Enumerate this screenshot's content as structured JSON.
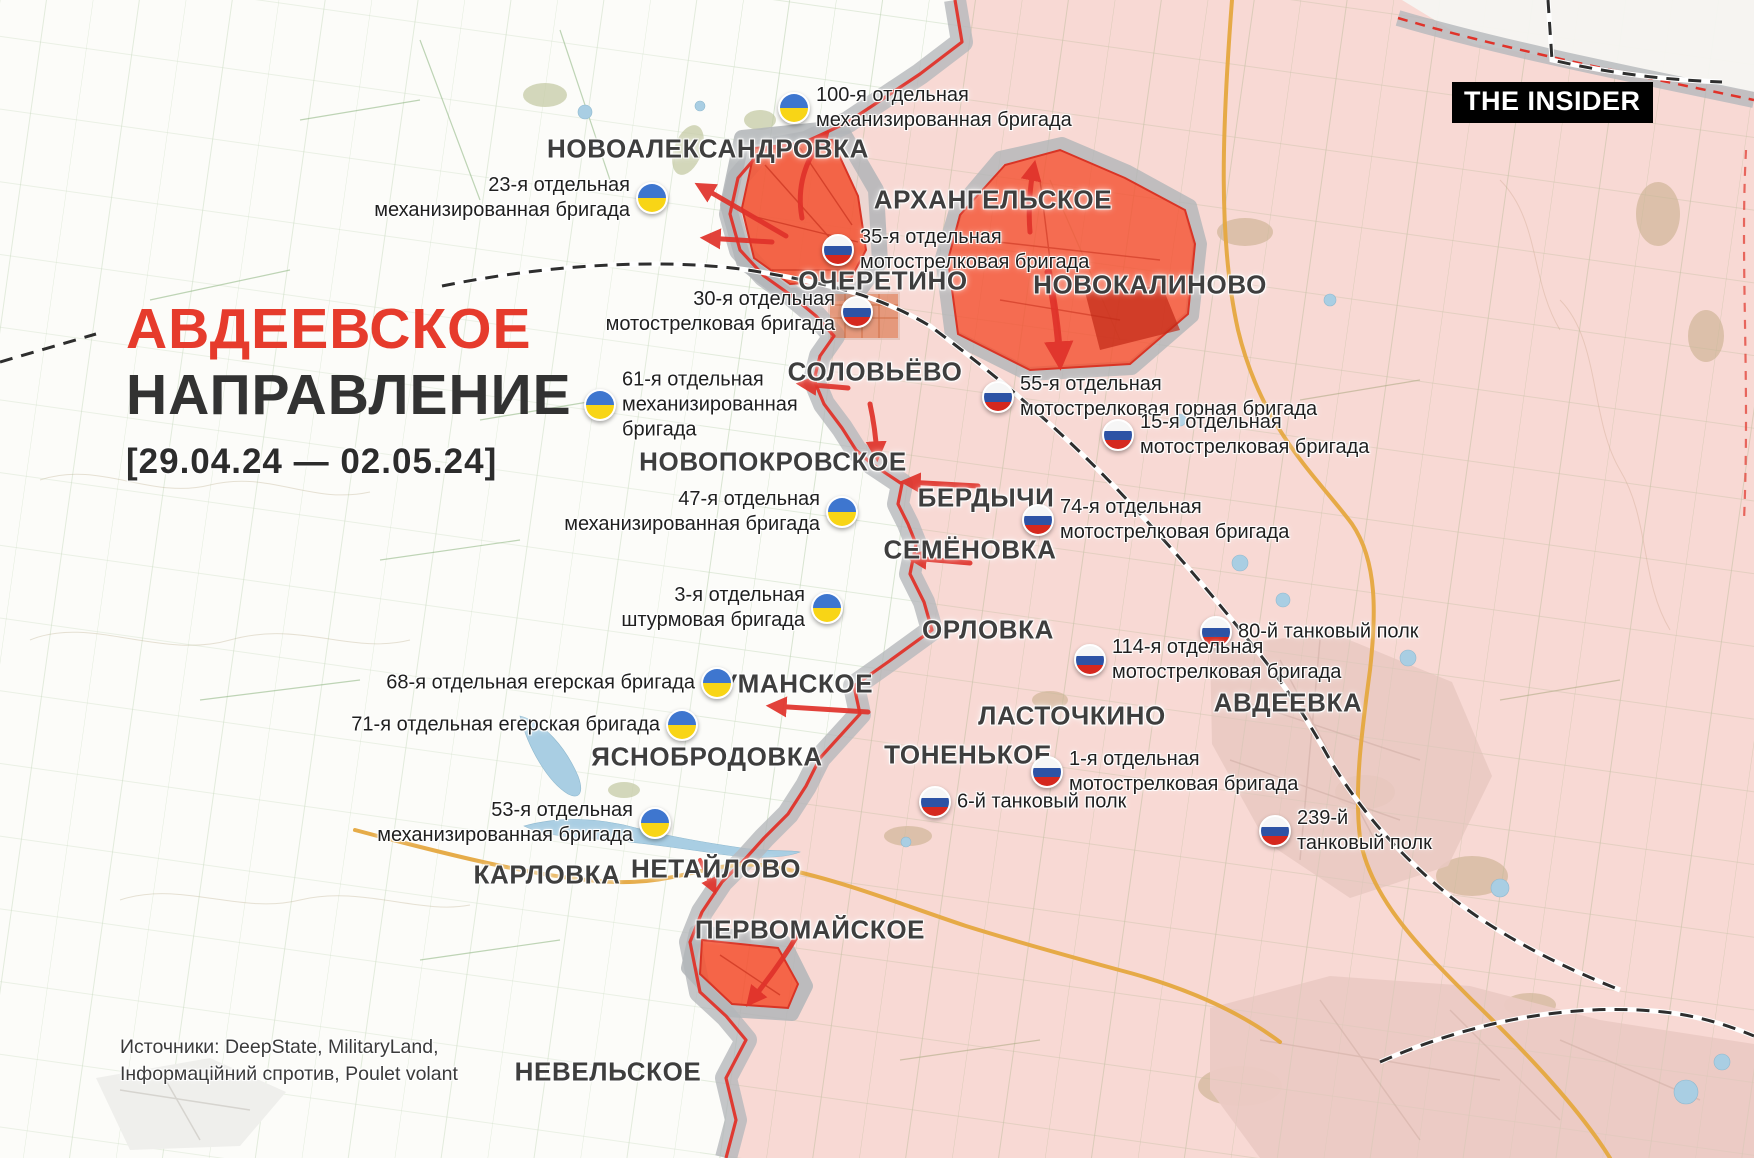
{
  "brand": {
    "logo_text": "THE INSIDER"
  },
  "header": {
    "title_line1": "АВДЕЕВСКОЕ",
    "title_line2": "НАПРАВЛЕНИЕ",
    "date_range": "[29.04.24 — 02.05.24]"
  },
  "sources": {
    "line1": "Источники: DeepState, MilitaryLand,",
    "line2": "Інформаційний спротив, Poulet volant"
  },
  "legend_colors": {
    "title_red": "#e63b2c",
    "front_line_red": "#e0332a",
    "assault_area_red": "#f4502f",
    "occupied_pink": "#f6dad6",
    "gray_zone": "#b5b8bb",
    "road_orange": "#e5a83f",
    "railway_black": "#2e2e2e",
    "ukraine_flag_blue": "#3e76cf",
    "ukraine_flag_yellow": "#f8d516",
    "russia_flag_blue": "#2d53a5",
    "russia_flag_red": "#d5281e"
  },
  "places": [
    {
      "name": "НОВОАЛЕКСАНДРОВКА",
      "x": 708,
      "y": 149
    },
    {
      "name": "АРХАНГЕЛЬСКОЕ",
      "x": 993,
      "y": 200
    },
    {
      "name": "ОЧЕРЕТИНО",
      "x": 883,
      "y": 281
    },
    {
      "name": "НОВОКАЛИНОВО",
      "x": 1150,
      "y": 285
    },
    {
      "name": "СОЛОВЬЁВО",
      "x": 875,
      "y": 372
    },
    {
      "name": "НОВОПОКРОВСКОЕ",
      "x": 773,
      "y": 462
    },
    {
      "name": "БЕРДЫЧИ",
      "x": 986,
      "y": 498
    },
    {
      "name": "СЕМЁНОВКА",
      "x": 970,
      "y": 550
    },
    {
      "name": "ОРЛОВКА",
      "x": 988,
      "y": 630
    },
    {
      "name": "УМАНСКОЕ",
      "x": 797,
      "y": 684
    },
    {
      "name": "ЛАСТОЧКИНО",
      "x": 1072,
      "y": 716
    },
    {
      "name": "АВДЕЕВКА",
      "x": 1288,
      "y": 703
    },
    {
      "name": "ТОНЕНЬКОЕ",
      "x": 968,
      "y": 755
    },
    {
      "name": "ЯСНОБРОДОВКА",
      "x": 707,
      "y": 757
    },
    {
      "name": "КАРЛОВКА",
      "x": 547,
      "y": 875
    },
    {
      "name": "НЕТАЙЛОВО",
      "x": 716,
      "y": 869
    },
    {
      "name": "ПЕРВОМАЙСКОЕ",
      "x": 810,
      "y": 930
    },
    {
      "name": "НЕВЕЛЬСКОЕ",
      "x": 608,
      "y": 1072
    }
  ],
  "units": [
    {
      "side": "ua",
      "x": 794,
      "y": 108,
      "align": "right",
      "lines": [
        "100-я отдельная",
        "механизированная бригада"
      ]
    },
    {
      "side": "ua",
      "x": 652,
      "y": 198,
      "align": "left",
      "lines": [
        "23-я отдельная",
        "механизированная бригада"
      ]
    },
    {
      "side": "ru",
      "x": 838,
      "y": 250,
      "align": "right",
      "lines": [
        "35-я отдельная",
        "мотострелковая бригада"
      ]
    },
    {
      "side": "ru",
      "x": 857,
      "y": 312,
      "align": "left",
      "lines": [
        "30-я отдельная",
        "мотострелковая бригада"
      ]
    },
    {
      "side": "ua",
      "x": 600,
      "y": 405,
      "align": "right",
      "lines": [
        "61-я отдельная",
        "механизированная",
        "бригада"
      ]
    },
    {
      "side": "ru",
      "x": 998,
      "y": 397,
      "align": "right",
      "lines": [
        "55-я отдельная",
        "мотострелковая горная бригада"
      ]
    },
    {
      "side": "ru",
      "x": 1118,
      "y": 435,
      "align": "right",
      "lines": [
        "15-я отдельная",
        "мотострелковая бригада"
      ]
    },
    {
      "side": "ua",
      "x": 842,
      "y": 512,
      "align": "left",
      "lines": [
        "47-я отдельная",
        "механизированная бригада"
      ]
    },
    {
      "side": "ru",
      "x": 1038,
      "y": 520,
      "align": "right",
      "lines": [
        "74-я отдельная",
        "мотострелковая бригада"
      ]
    },
    {
      "side": "ua",
      "x": 827,
      "y": 608,
      "align": "left",
      "lines": [
        "3-я отдельная",
        "штурмовая бригада"
      ]
    },
    {
      "side": "ru",
      "x": 1216,
      "y": 632,
      "align": "right",
      "lines": [
        "80-й танковый полк"
      ]
    },
    {
      "side": "ru",
      "x": 1090,
      "y": 660,
      "align": "right",
      "lines": [
        "114-я отдельная",
        "мотострелковая бригада"
      ]
    },
    {
      "side": "ua",
      "x": 717,
      "y": 683,
      "align": "left",
      "lines": [
        "68-я отдельная егерская бригада"
      ]
    },
    {
      "side": "ua",
      "x": 682,
      "y": 725,
      "align": "left",
      "lines": [
        "71-я отдельная егерская бригада"
      ]
    },
    {
      "side": "ru",
      "x": 1047,
      "y": 772,
      "align": "right",
      "lines": [
        "1-я отдельная",
        "мотострелковая бригада"
      ]
    },
    {
      "side": "ru",
      "x": 935,
      "y": 802,
      "align": "right",
      "lines": [
        "6-й танковый полк"
      ]
    },
    {
      "side": "ua",
      "x": 655,
      "y": 823,
      "align": "left",
      "lines": [
        "53-я отдельная",
        "механизированная бригада"
      ]
    },
    {
      "side": "ru",
      "x": 1275,
      "y": 831,
      "align": "right",
      "lines": [
        "239-й",
        "танковый полк"
      ]
    }
  ]
}
